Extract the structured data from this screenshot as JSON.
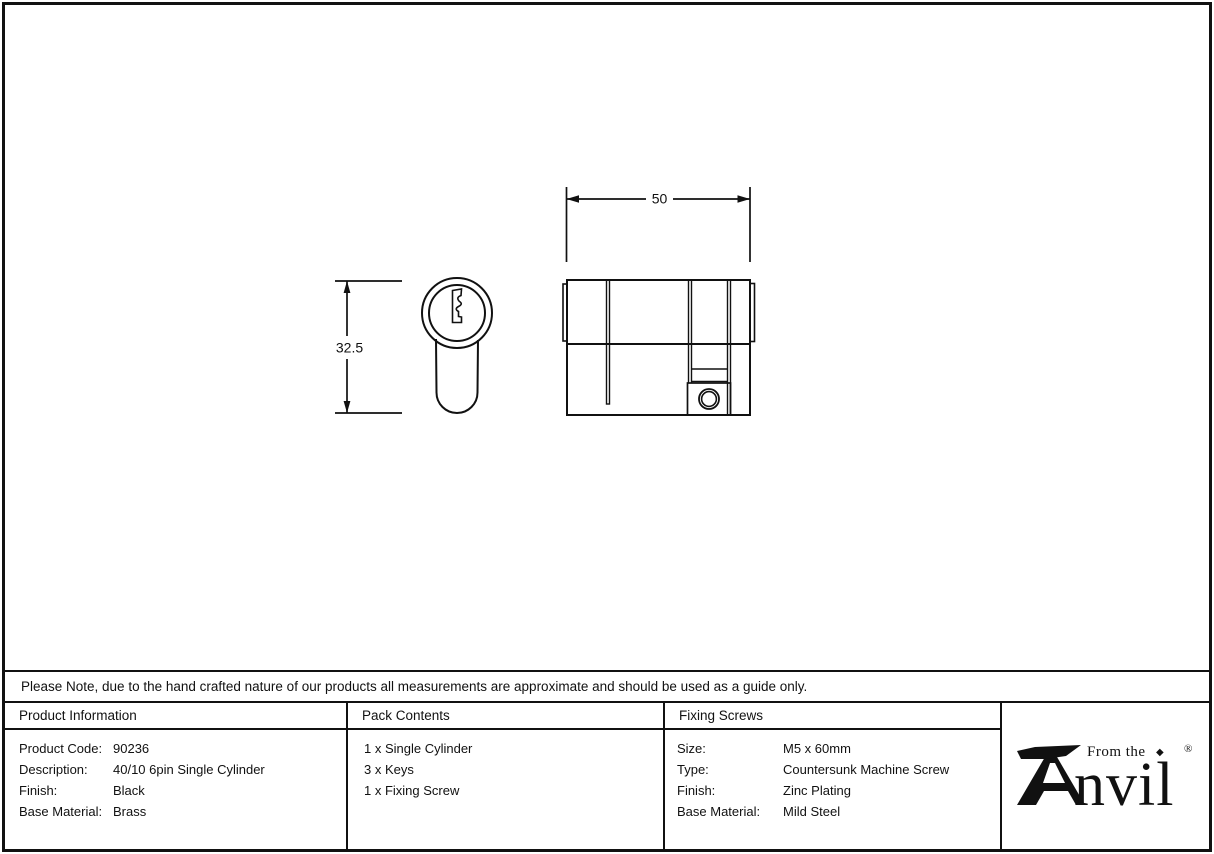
{
  "drawing": {
    "width_dimension": "50",
    "height_dimension": "32.5"
  },
  "note": "Please Note, due to the hand crafted nature of our products all measurements are approximate and should be used as a guide only.",
  "columns": {
    "product_information": {
      "header": "Product Information",
      "rows": [
        {
          "label": "Product Code:",
          "value": "90236"
        },
        {
          "label": "Description:",
          "value": "40/10 6pin Single Cylinder"
        },
        {
          "label": "Finish:",
          "value": "Black"
        },
        {
          "label": "Base Material:",
          "value": "Brass"
        }
      ]
    },
    "pack_contents": {
      "header": "Pack Contents",
      "items": [
        "1 x Single Cylinder",
        "3 x Keys",
        "1 x Fixing Screw"
      ]
    },
    "fixing_screws": {
      "header": "Fixing Screws",
      "rows": [
        {
          "label": "Size:",
          "value": "M5 x 60mm"
        },
        {
          "label": "Type:",
          "value": "Countersunk Machine Screw"
        },
        {
          "label": "Finish:",
          "value": "Zinc Plating"
        },
        {
          "label": "Base Material:",
          "value": "Mild Steel"
        }
      ]
    }
  },
  "logo": {
    "brand": "Anvil",
    "tagline": "From the",
    "brand_suffix": "nvil",
    "diamond": "◆",
    "registered_mark": "®"
  },
  "colors": {
    "ink": "#111111",
    "background": "#ffffff"
  }
}
